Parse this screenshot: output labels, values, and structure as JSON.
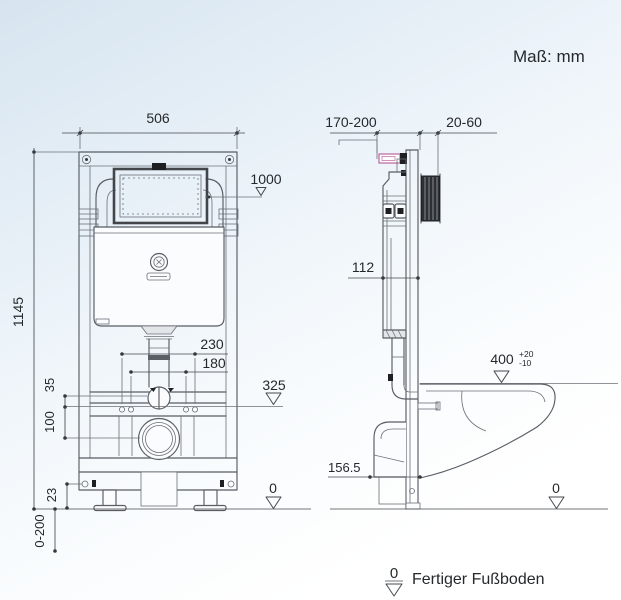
{
  "header": {
    "units_label": "Maß: mm"
  },
  "front_view": {
    "width": "506",
    "height": "1145",
    "plate_level": "1000",
    "spacing_outer": "230",
    "spacing_inner": "180",
    "outlet_level": "325",
    "gap_top": "35",
    "gap_bottom": "100",
    "foot_bolt": "23",
    "foot_range": "0-200",
    "floor": "0"
  },
  "side_view": {
    "front_range": "170-200",
    "wall_range": "20-60",
    "depth": "112",
    "bowl_height": "400",
    "tol_plus": "+20",
    "tol_minus": "-10",
    "outlet_depth": "156.5",
    "floor": "0"
  },
  "legend": {
    "zero_symbol": "0",
    "floor_label": "Fertiger Fußboden"
  },
  "colors": {
    "line": "#585d64",
    "text": "#26292c",
    "accent_pink": "#bb65a2",
    "dark_fill": "#1d1f22",
    "background_top": "#d7e4ef",
    "background_bottom": "#ffffff"
  }
}
